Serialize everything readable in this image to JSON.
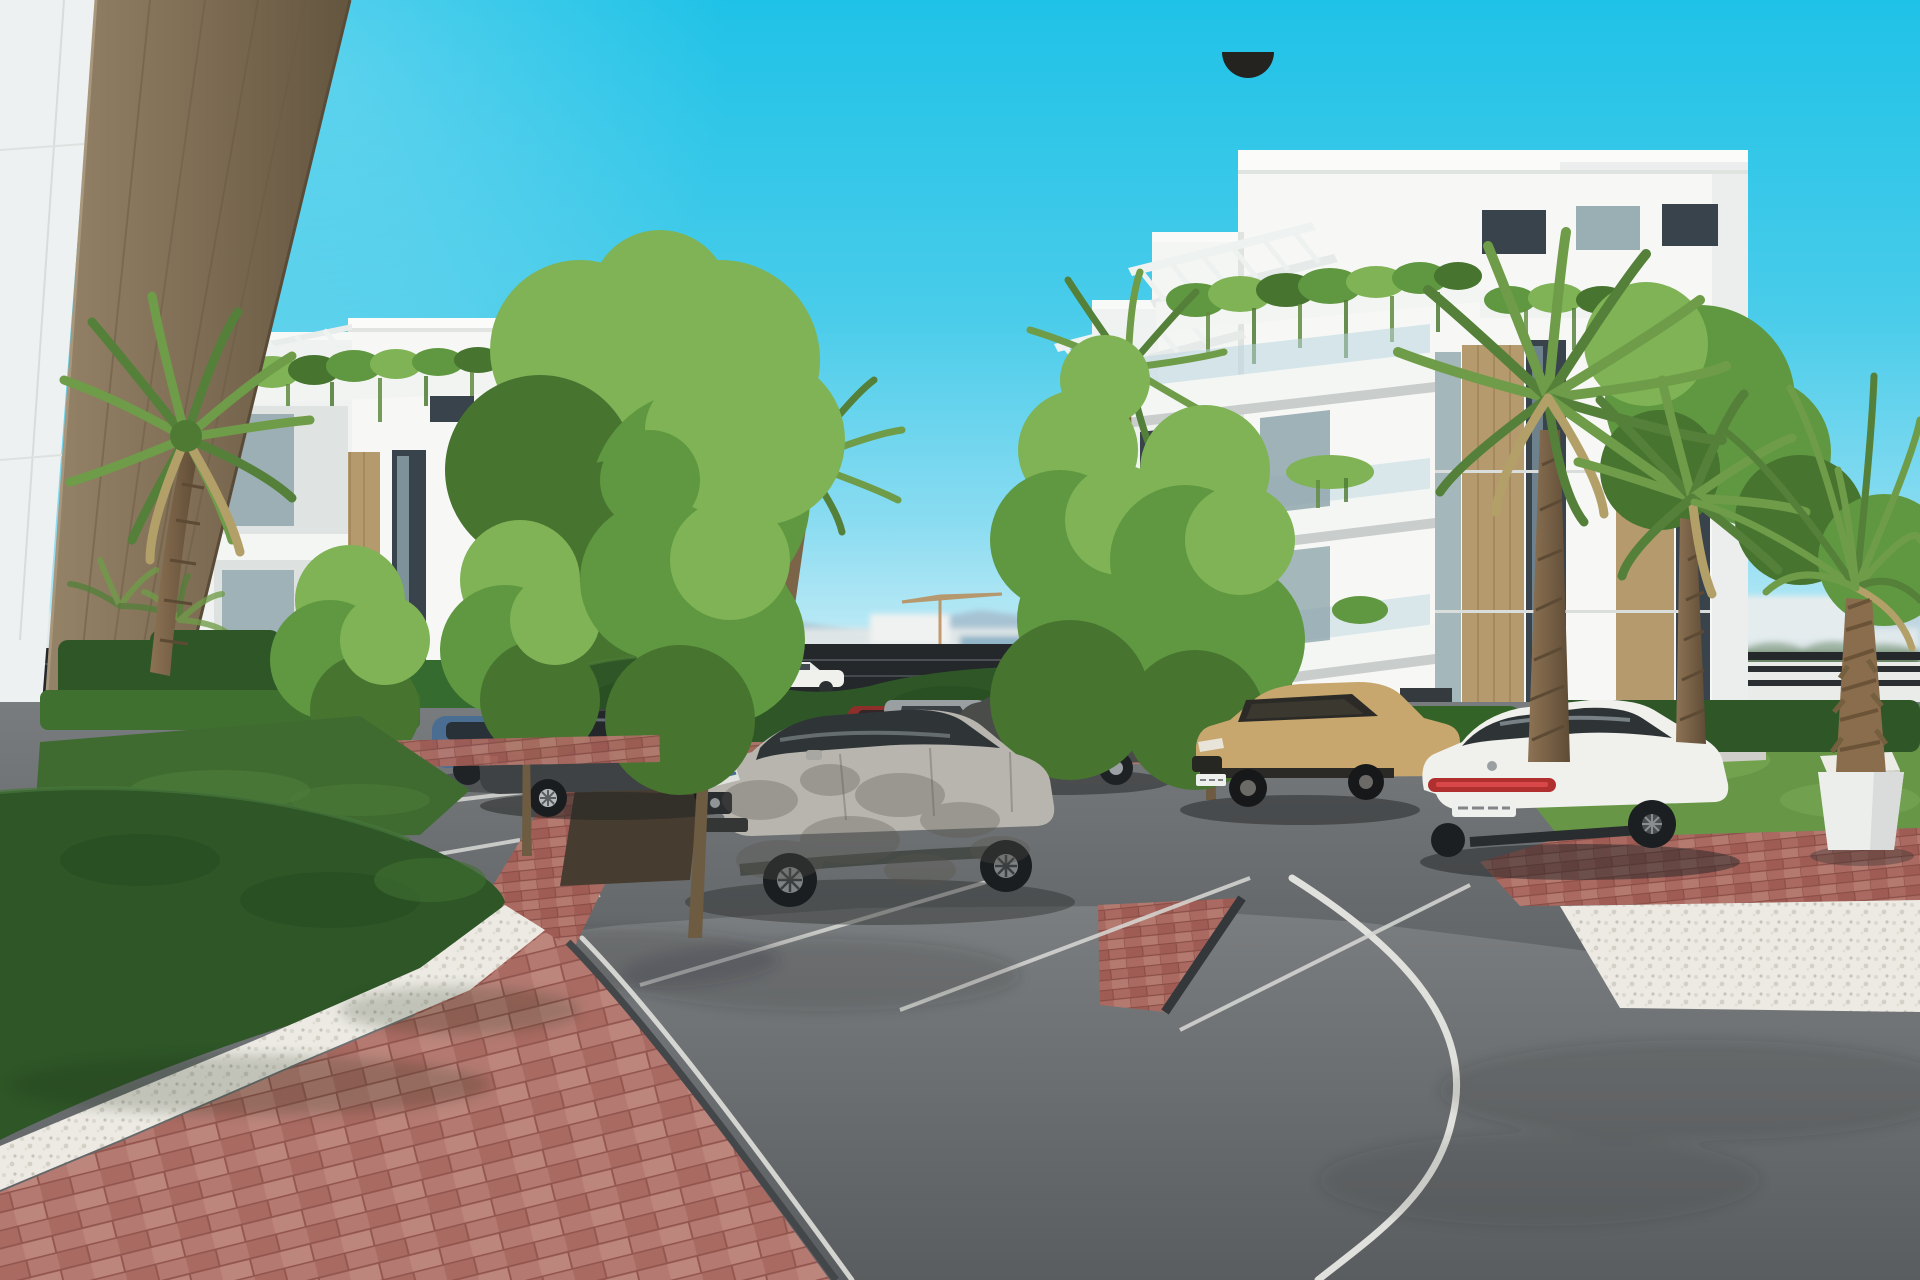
{
  "scene": {
    "title": "Residential complex exterior — architectural render",
    "description": "Sunny 3D architectural rendering of a modern white apartment complex: two white buildings with rooftop pergolas, hanging balcony plants and tan stone strips, palm trees and bright green trees, boxwood hedges, a parking lot with parked cars (blue hatchback, dark sedan, light gray SUV with dappled tree shadows, red compact SUV, silver SUV, dark large SUV, tan SUV with black roof, white fastback sedan), a white car passing on a rear road, a curving asphalt road with white edge lines, red brick walkways, white gravel beds, concrete benches, a white parasol with sun loungers behind a hedge, and a distant city skyline with construction cranes and hazy mountains under a cyan sky.",
    "time_of_day": "daytime, clear sky",
    "license_plates": "visible but illegible"
  },
  "colors": {
    "sky_top": "#1fc2e7",
    "sky_horizon": "#e8f7fb",
    "building_white": "#f7f8f6",
    "building_shade": "#ebeeec",
    "facade_tan": "#b59a6d",
    "wood_column": "#83715​5",
    "hedge_dark": "#2e5627",
    "hedge_light": "#3f7030",
    "tree_green_light": "#7fb356",
    "tree_green": "#5f9840",
    "tree_green_dark": "#47742f",
    "lawn_green": "#3f6b31",
    "grass_sunlit": "#679647",
    "palm_green": "#6f9c48",
    "palm_green_dark": "#55803a",
    "palm_dry": "#b3a068",
    "trunk_brown": "#6d5b42",
    "asphalt": "#6d7072",
    "asphalt_dark": "#54585a",
    "road_line_white": "#e0e0dc",
    "brick_red": "#b2766e",
    "gravel_white": "#eceae3",
    "fence_dark": "#24282b",
    "mountain_haze": "#9fb4c4",
    "window_glass": "#8fa6ad",
    "window_dark": "#39434b",
    "car_gray": "#b7b5ae",
    "car_dark": "#3e4245",
    "car_blue": "#4a6d92",
    "car_red": "#8e2f2c",
    "car_silver": "#9aa0a2",
    "car_tan": "#c7a76e",
    "car_white": "#f0f0ec",
    "taillight_red": "#b03030"
  },
  "objects": {
    "buildings": [
      {
        "label": "foreground-building-corner",
        "materials": [
          "white panel wall",
          "wood-tone pillar"
        ]
      },
      {
        "label": "left-apartment-building",
        "features": [
          "rooftop pergola",
          "hanging plants",
          "tan stone strips",
          "recessed balconies"
        ]
      },
      {
        "label": "right-apartment-building",
        "features": [
          "two rooftop pergolas",
          "hanging ivy parapet",
          "stepped balconies with glass rails",
          "tan wood strips",
          "dark window columns"
        ]
      }
    ],
    "vehicles": [
      {
        "label": "background-white-car",
        "color_key": "car_white",
        "state": "driving on rear road"
      },
      {
        "label": "blue-hatchback",
        "color_key": "car_blue",
        "state": "parked"
      },
      {
        "label": "dark-gray-sedan",
        "color_key": "car_dark",
        "state": "parked"
      },
      {
        "label": "red-compact-suv",
        "color_key": "car_red",
        "state": "parked"
      },
      {
        "label": "silver-suv",
        "color_key": "car_silver",
        "state": "parked"
      },
      {
        "label": "dark-large-suv",
        "color_key": "car_dark",
        "state": "parked"
      },
      {
        "label": "light-gray-suv-foreground",
        "color_key": "car_gray",
        "state": "parked, dappled tree shadows"
      },
      {
        "label": "tan-suv-black-roof",
        "color_key": "car_tan",
        "state": "parked"
      },
      {
        "label": "white-fastback-sedan",
        "color_key": "car_white",
        "state": "parked, red taillight bar"
      }
    ],
    "vegetation": [
      "fan palms",
      "date palm in white planter",
      "deciduous green trees",
      "boxwood hedges",
      "lawn",
      "hanging ivy"
    ],
    "site": [
      "parking stalls with white lines",
      "red brick walkways and median island",
      "white gravel beds",
      "curving asphalt road with white edge line",
      "concrete benches",
      "white parasol with sun loungers",
      "dark metal pool fence",
      "distant skyline with construction cranes",
      "hazy mountains"
    ]
  }
}
